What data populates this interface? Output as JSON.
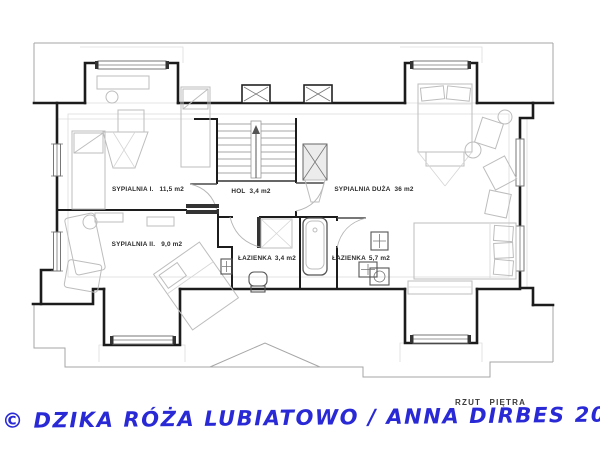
{
  "plan": {
    "title": "RZUT PIĘTRA",
    "rooms": [
      {
        "name": "SYPIALNIA I.",
        "area": "11,5 m2"
      },
      {
        "name": "HOL",
        "area": "3,4 m2"
      },
      {
        "name": "SYPIALNIA DUŻA",
        "area": "36 m2"
      },
      {
        "name": "SYPIALNIA II.",
        "area": "9,0 m2"
      },
      {
        "name": "ŁAZIENKA",
        "area": "3,4 m2"
      },
      {
        "name": "ŁAZIENKA",
        "area": "5,7 m2"
      }
    ]
  },
  "caption": {
    "text": "© DZIKA RÓŻA LUBIATOWO / ANNA DIRBES 2022"
  },
  "colors": {
    "walls": "#1c1c1c",
    "roof_outline": "#a6a6a6",
    "furniture": "#bdbdbd",
    "label_text": "#2b2b2b",
    "caption_blue": "#2929d6"
  }
}
